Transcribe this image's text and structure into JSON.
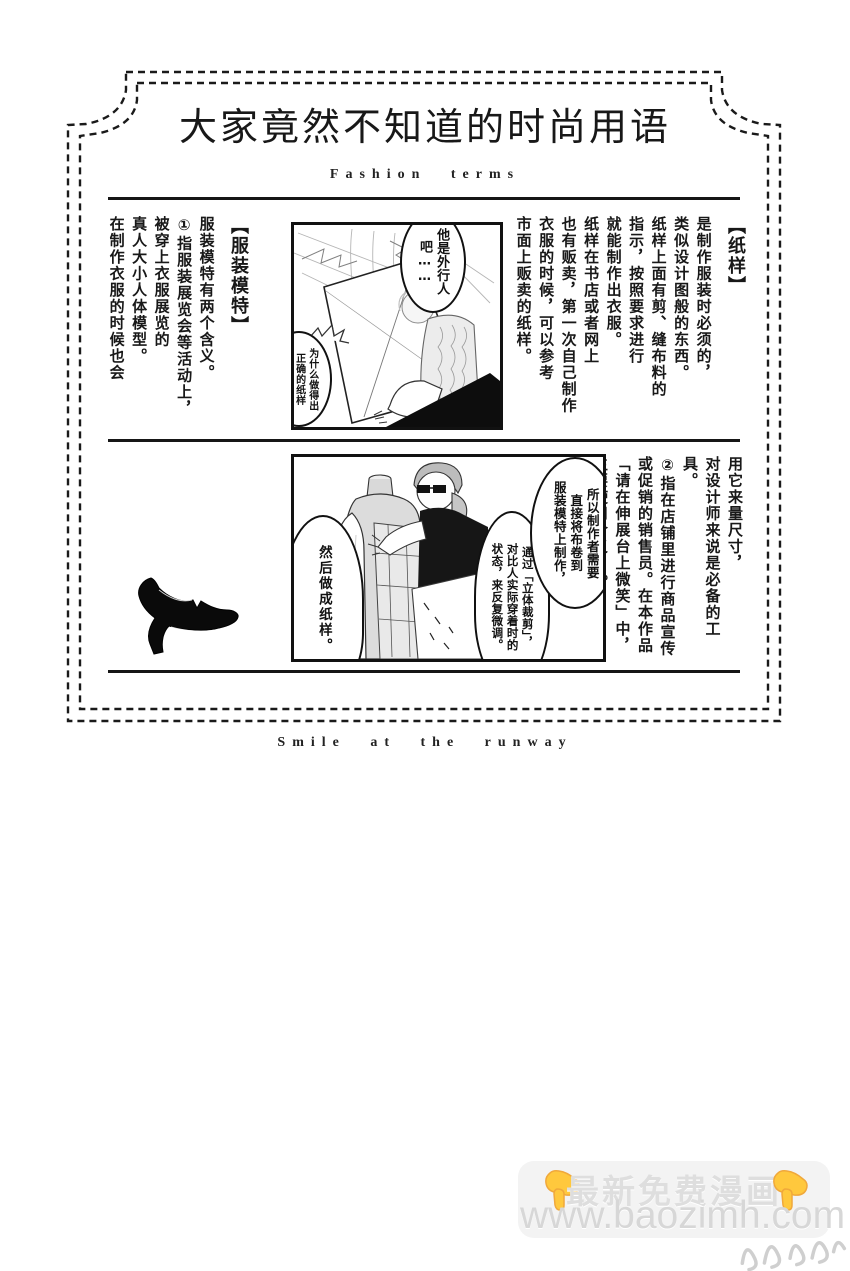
{
  "header": {
    "title": "大家竟然不知道的时尚用语",
    "subtitle": "Fashion terms",
    "footer": "Smile at the runway"
  },
  "terms": [
    {
      "term": "【纸样】",
      "lines": [
        "是制作服装时必须的，",
        "类似设计图般的东西。",
        "纸样上面有剪、缝布料的",
        "指示，按照要求进行",
        "就能制作出衣服。",
        "纸样在书店或者网上",
        "也有贩卖，第一次自己制作",
        "衣服的时候，可以参考",
        "市面上贩卖的纸样。"
      ]
    },
    {
      "term": "【服装模特】",
      "lines": [
        "服装模特有两个含义。",
        "①指服装展览会等活动上，",
        "被穿上衣服展览的",
        "真人大小人体模型。",
        "在制作衣服的时候也会"
      ]
    },
    {
      "term": "",
      "lines": [
        "用它来量尺寸，",
        "对设计师来说是必备的工具。",
        "②指在店铺里进行商品宣传",
        "或促销的销售员。在本作品",
        "「请在伸展台上微笑」中，",
        "主要使用含义①。"
      ]
    }
  ],
  "panel1": {
    "bubbles": [
      [
        "他是外行人",
        "吧……"
      ],
      [
        "为什么做得出",
        "正确的纸样",
        "……"
      ]
    ]
  },
  "panel2": {
    "bubbles": [
      [
        "所以制作者需要",
        "直接将布卷到",
        "服装模特上制作，"
      ],
      [
        "通过「立体裁剪」，",
        "对比人实际穿着时的",
        "状态，来反复微调。"
      ],
      [
        "然后做成纸样。"
      ]
    ]
  },
  "watermark": {
    "line1": "最新免费漫画",
    "line2": "www.baozimh.com",
    "hand_icon": "pointing-down-hand",
    "colors": {
      "hand": "#FFC83D",
      "hand_shade": "#F0A83B",
      "text": "#dedede",
      "box": "#f3f3f3"
    }
  },
  "decor": {
    "frame_color": "#1a1a1a",
    "shoe_icon": "high-heel-pump-silhouette",
    "scribble_icon": "faint-cursive-scribble"
  }
}
